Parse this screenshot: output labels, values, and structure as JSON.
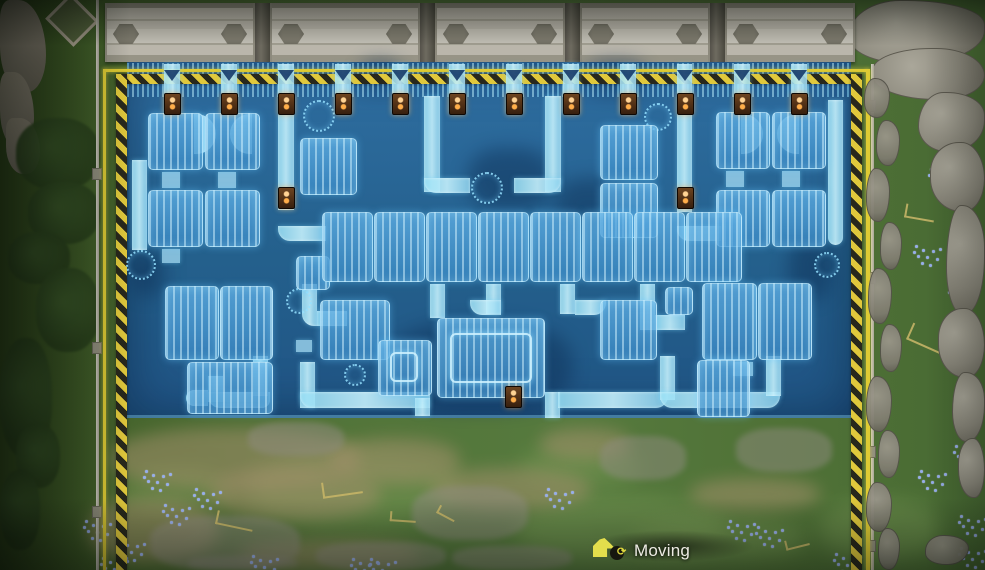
{
  "hud": {
    "mode_label": "Moving",
    "rotate_glyph": "⟳"
  },
  "colors": {
    "designator_yellow": "#decb34",
    "hazard_dark": "#28281c",
    "blueprint_blue": "#23608f",
    "belt_cyan": "#aadef4",
    "pole_glow": "#ffae4a",
    "grass": "#527439",
    "structure_gray": "#bab6ab"
  },
  "scene": {
    "structures": {
      "segments": [
        [
          105,
          150
        ],
        [
          270,
          150
        ],
        [
          435,
          130
        ],
        [
          580,
          130
        ],
        [
          725,
          130
        ]
      ],
      "gaps": [
        255,
        420,
        565,
        710
      ]
    },
    "floor": [
      127,
      62,
      724,
      356
    ],
    "floor_edge": [
      127,
      415,
      724,
      3
    ],
    "belt_band": [
      127,
      63,
      724,
      34
    ],
    "designator": {
      "line_top": [
        103,
        69,
        766,
        3
      ],
      "line_left": [
        103,
        69,
        3,
        501
      ],
      "line_right": [
        866,
        69,
        4,
        501
      ],
      "hazard_top": [
        116,
        74,
        740,
        10
      ],
      "hazard_left": [
        116,
        74,
        11,
        496
      ],
      "hazard_right": [
        851,
        74,
        11,
        496
      ]
    },
    "arrows": {
      "y": 70,
      "xs": [
        172,
        229,
        286,
        343,
        400,
        457,
        514,
        571,
        628,
        685,
        742,
        799
      ]
    },
    "poles": [
      [
        164,
        93
      ],
      [
        221,
        93
      ],
      [
        278,
        93
      ],
      [
        335,
        93
      ],
      [
        392,
        93
      ],
      [
        449,
        93
      ],
      [
        506,
        93
      ],
      [
        563,
        93
      ],
      [
        620,
        93
      ],
      [
        677,
        93
      ],
      [
        734,
        93
      ],
      [
        791,
        93
      ],
      [
        278,
        187
      ],
      [
        677,
        187
      ],
      [
        505,
        386
      ]
    ],
    "machines": [
      [
        148,
        113,
        55,
        57
      ],
      [
        205,
        113,
        55,
        57
      ],
      [
        148,
        190,
        55,
        57
      ],
      [
        205,
        190,
        55,
        57
      ],
      [
        300,
        138,
        57,
        57
      ],
      [
        296,
        256,
        34,
        34
      ],
      [
        600,
        125,
        58,
        55
      ],
      [
        600,
        183,
        58,
        55
      ],
      [
        665,
        287,
        28,
        28
      ],
      [
        716,
        112,
        54,
        57
      ],
      [
        772,
        112,
        54,
        57
      ],
      [
        716,
        190,
        54,
        57
      ],
      [
        772,
        190,
        54,
        57
      ],
      [
        322,
        212,
        51,
        70
      ],
      [
        374,
        212,
        51,
        70
      ],
      [
        426,
        212,
        51,
        70
      ],
      [
        478,
        212,
        51,
        70
      ],
      [
        530,
        212,
        51,
        70
      ],
      [
        582,
        212,
        51,
        70
      ],
      [
        634,
        212,
        51,
        70
      ],
      [
        686,
        212,
        56,
        70
      ],
      [
        165,
        286,
        54,
        74
      ],
      [
        220,
        286,
        53,
        74
      ],
      [
        187,
        362,
        86,
        52
      ],
      [
        320,
        300,
        70,
        60
      ],
      [
        378,
        340,
        54,
        56
      ],
      [
        437,
        318,
        108,
        80
      ],
      [
        600,
        300,
        57,
        60
      ],
      [
        702,
        283,
        55,
        77
      ],
      [
        758,
        283,
        54,
        77
      ],
      [
        697,
        360,
        53,
        57
      ]
    ],
    "glow_frames": [
      [
        390,
        352,
        28,
        30
      ],
      [
        450,
        333,
        82,
        50
      ]
    ],
    "belts": [
      [
        164,
        64,
        16,
        50
      ],
      [
        221,
        64,
        16,
        50
      ],
      [
        335,
        64,
        16,
        50
      ],
      [
        392,
        64,
        16,
        50
      ],
      [
        449,
        64,
        16,
        50
      ],
      [
        506,
        64,
        16,
        50
      ],
      [
        563,
        64,
        16,
        50
      ],
      [
        620,
        64,
        16,
        50
      ],
      [
        734,
        64,
        16,
        50
      ],
      [
        791,
        64,
        16,
        50
      ],
      [
        278,
        64,
        16,
        146
      ],
      [
        278,
        226,
        48,
        15,
        "0 0 0 12px"
      ],
      [
        677,
        64,
        15,
        148
      ],
      [
        677,
        226,
        44,
        15,
        "0 0 0 12px"
      ],
      [
        194,
        114,
        22,
        40,
        "0 22px 22px 0"
      ],
      [
        230,
        114,
        22,
        40,
        "22px 0 0 22px"
      ],
      [
        741,
        114,
        22,
        40,
        "0 22px 22px 0"
      ],
      [
        777,
        114,
        22,
        40,
        "22px 0 0 22px"
      ],
      [
        424,
        96,
        16,
        96
      ],
      [
        424,
        178,
        46,
        15,
        "0 0 0 12px"
      ],
      [
        545,
        96,
        16,
        96
      ],
      [
        514,
        178,
        47,
        15,
        "0 0 12px 0"
      ],
      [
        828,
        100,
        15,
        145,
        "0 0 8px 8px"
      ],
      [
        132,
        160,
        15,
        90
      ],
      [
        302,
        284,
        15,
        42,
        "0 0 0 12px"
      ],
      [
        317,
        311,
        30,
        15
      ],
      [
        486,
        284,
        15,
        30
      ],
      [
        470,
        300,
        31,
        15,
        "0 0 0 12px"
      ],
      [
        560,
        284,
        15,
        30
      ],
      [
        575,
        300,
        31,
        15,
        "0 0 12px 0"
      ],
      [
        640,
        284,
        15,
        46
      ],
      [
        655,
        315,
        30,
        15
      ],
      [
        430,
        284,
        15,
        34
      ],
      [
        208,
        376,
        15,
        26
      ],
      [
        208,
        392,
        62,
        16,
        "0 0 8px 12px"
      ],
      [
        253,
        356,
        15,
        40
      ],
      [
        300,
        362,
        15,
        46
      ],
      [
        300,
        392,
        130,
        16,
        "0 0 0 12px"
      ],
      [
        415,
        398,
        15,
        18
      ],
      [
        545,
        392,
        15,
        26
      ],
      [
        558,
        392,
        110,
        16,
        "0 0 12px 0"
      ],
      [
        660,
        356,
        15,
        44
      ],
      [
        660,
        392,
        120,
        16,
        "0 0 12px 12px"
      ],
      [
        766,
        356,
        15,
        40
      ],
      [
        186,
        390,
        22,
        16,
        "12px 0 0 12px"
      ]
    ],
    "pads": [
      [
        162,
        172,
        18,
        16
      ],
      [
        218,
        172,
        18,
        16
      ],
      [
        726,
        171,
        18,
        16
      ],
      [
        782,
        171,
        18,
        16
      ],
      [
        162,
        249,
        18,
        14
      ],
      [
        733,
        362,
        20,
        14
      ],
      [
        296,
        340,
        16,
        12
      ]
    ],
    "rings": [
      [
        303,
        100,
        32
      ],
      [
        471,
        172,
        32
      ],
      [
        644,
        103,
        28
      ],
      [
        286,
        288,
        26
      ],
      [
        814,
        252,
        26
      ],
      [
        344,
        364,
        22
      ],
      [
        126,
        250,
        30
      ]
    ],
    "dark_patches": [
      [
        468,
        148,
        84,
        62
      ],
      [
        388,
        322,
        184,
        88
      ],
      [
        556,
        178,
        72,
        52
      ],
      [
        130,
        252,
        34,
        44
      ],
      [
        788,
        238,
        44,
        62
      ],
      [
        586,
        60,
        60,
        34
      ],
      [
        360,
        60,
        40,
        30
      ]
    ],
    "terrain": {
      "washes": [
        [
          250,
          452,
          210,
          74
        ],
        [
          516,
          498,
          210,
          64
        ],
        [
          116,
          468,
          110,
          44
        ],
        [
          634,
          518,
          170,
          44
        ],
        [
          520,
          446,
          120,
          40
        ],
        [
          820,
          500,
          120,
          60
        ]
      ],
      "dirt": [
        [
          110,
          428,
          250,
          62
        ],
        [
          210,
          468,
          170,
          52
        ],
        [
          330,
          438,
          130,
          46
        ],
        [
          88,
          498,
          130,
          64
        ],
        [
          430,
          468,
          160,
          42
        ],
        [
          690,
          478,
          130,
          32
        ],
        [
          540,
          428,
          90,
          32
        ],
        [
          240,
          540,
          180,
          30
        ]
      ],
      "pebbles": [
        [
          150,
          516,
          150,
          54
        ],
        [
          248,
          422,
          96,
          34
        ],
        [
          412,
          486,
          116,
          54
        ],
        [
          600,
          436,
          86,
          44
        ],
        [
          736,
          428,
          96,
          44
        ],
        [
          316,
          542,
          130,
          28
        ],
        [
          188,
          556,
          110,
          14
        ],
        [
          452,
          546,
          120,
          24
        ]
      ],
      "twigs": [
        [
          322,
          480,
          40,
          16,
          -8
        ],
        [
          216,
          514,
          38,
          14,
          12
        ],
        [
          390,
          512,
          26,
          10,
          4
        ],
        [
          437,
          509,
          20,
          9,
          28
        ],
        [
          785,
          538,
          24,
          10,
          -14
        ],
        [
          908,
          330,
          40,
          18,
          24
        ],
        [
          905,
          206,
          30,
          14,
          10
        ]
      ],
      "flowers": [
        [
          143,
          468
        ],
        [
          162,
          502
        ],
        [
          117,
          538
        ],
        [
          193,
          486
        ],
        [
          83,
          518
        ],
        [
          100,
          555
        ],
        [
          250,
          553
        ],
        [
          545,
          486
        ],
        [
          350,
          556
        ],
        [
          727,
          518
        ],
        [
          755,
          524
        ],
        [
          913,
          243
        ],
        [
          948,
          283
        ],
        [
          928,
          166
        ],
        [
          953,
          443
        ],
        [
          918,
          468
        ],
        [
          958,
          513
        ],
        [
          833,
          551
        ],
        [
          958,
          545
        ],
        [
          368,
          556
        ]
      ],
      "dot_pattern": [
        [
          2,
          2
        ],
        [
          9,
          6
        ],
        [
          4,
          12
        ],
        [
          13,
          13
        ],
        [
          19,
          7
        ],
        [
          8,
          19
        ],
        [
          16,
          21
        ],
        [
          23,
          15
        ],
        [
          26,
          5
        ],
        [
          0,
          8
        ]
      ],
      "rocks": [
        [
          848,
          0,
          137,
          64
        ],
        [
          872,
          48,
          113,
          52
        ],
        [
          918,
          92,
          67,
          60
        ],
        [
          930,
          142,
          55,
          70
        ],
        [
          946,
          205,
          39,
          110
        ],
        [
          938,
          308,
          47,
          70
        ],
        [
          952,
          372,
          33,
          70
        ],
        [
          958,
          438,
          27,
          60
        ]
      ],
      "rubble": [
        [
          864,
          78,
          26,
          40
        ],
        [
          876,
          120,
          24,
          46
        ],
        [
          866,
          168,
          24,
          54
        ],
        [
          880,
          222,
          22,
          48
        ],
        [
          868,
          268,
          24,
          56
        ],
        [
          880,
          324,
          22,
          48
        ],
        [
          866,
          376,
          26,
          56
        ],
        [
          878,
          430,
          22,
          48
        ],
        [
          866,
          482,
          26,
          50
        ],
        [
          878,
          528,
          22,
          42
        ],
        [
          925,
          535,
          44,
          30
        ]
      ],
      "cliffs": [
        [
          0,
          0,
          46,
          92
        ],
        [
          0,
          72,
          34,
          76
        ],
        [
          6,
          118,
          34,
          56
        ]
      ],
      "peak": [
        52,
        2,
        40,
        36
      ],
      "foliage": [
        [
          16,
          118,
          84,
          72
        ],
        [
          28,
          182,
          72,
          62
        ],
        [
          8,
          232,
          62,
          52
        ],
        [
          36,
          268,
          64,
          84
        ],
        [
          0,
          338,
          52,
          120
        ],
        [
          16,
          424,
          44,
          64
        ],
        [
          0,
          470,
          40,
          80
        ]
      ],
      "walls": {
        "vlines": [
          [
            96,
            0,
            3,
            570
          ],
          [
            871,
            64,
            3,
            506
          ]
        ],
        "posts": [
          [
            92,
            168
          ],
          [
            92,
            342
          ],
          [
            92,
            506
          ],
          [
            866,
            100
          ],
          [
            866,
            272
          ],
          [
            866,
            446
          ],
          [
            866,
            540
          ]
        ]
      }
    }
  }
}
